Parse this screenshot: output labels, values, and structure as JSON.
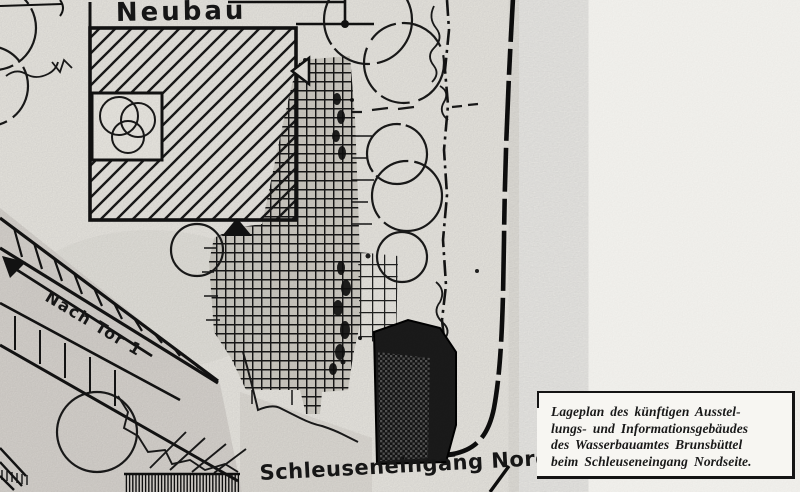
{
  "map": {
    "labels": {
      "new_building": "Neubau",
      "road_to_gate": "Nach Tor 1",
      "lock_entrance": "Schleuseneingang Nord"
    }
  },
  "caption": {
    "lines": [
      "Lageplan des künftigen Ausstel-",
      "lungs- und Informationsgebäudes",
      "des Wasserbauamtes Brunsbüttel",
      "beim Schleuseneingang Nordseite."
    ]
  },
  "colors": {
    "ink": "#161616",
    "paper": "#edebe5",
    "paper_light": "#f7f6f2",
    "shade_gray": "#d8d5cf"
  }
}
